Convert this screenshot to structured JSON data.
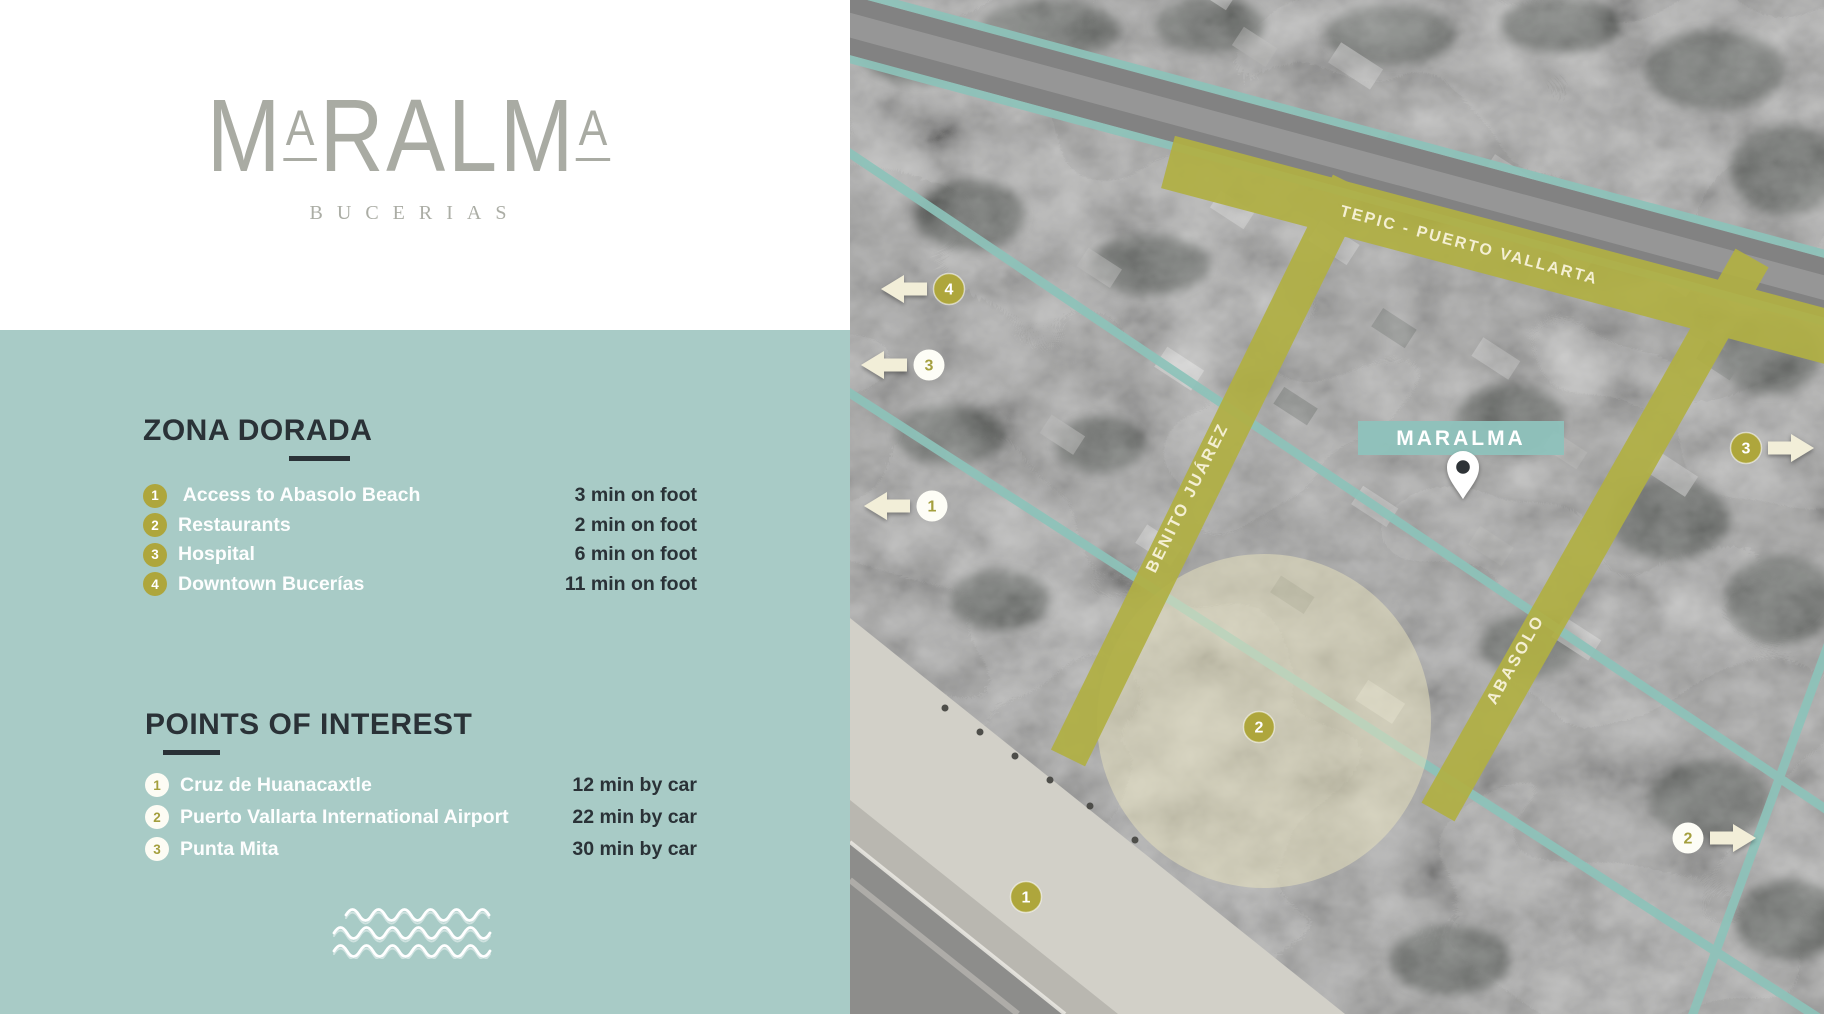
{
  "brand": {
    "logo_word": "MARALMA",
    "logo_letters": [
      {
        "ch": "M",
        "small": false
      },
      {
        "ch": "A",
        "small": true
      },
      {
        "ch": "R",
        "small": false
      },
      {
        "ch": "A",
        "small": false
      },
      {
        "ch": "L",
        "small": false
      },
      {
        "ch": "M",
        "small": false
      },
      {
        "ch": "A",
        "small": true
      }
    ],
    "subtitle": "BUCERIAS"
  },
  "zona_dorada": {
    "title": "ZONA DORADA",
    "items": [
      {
        "num": "1",
        "label": " Access to Abasolo Beach",
        "time": "3 min on foot"
      },
      {
        "num": "2",
        "label": "Restaurants",
        "time": "2 min on foot"
      },
      {
        "num": "3",
        "label": "Hospital",
        "time": "6 min on foot"
      },
      {
        "num": "4",
        "label": "Downtown Bucerías",
        "time": "11 min on foot"
      }
    ]
  },
  "points_of_interest": {
    "title": "POINTS OF INTEREST",
    "items": [
      {
        "num": "1",
        "label": "Cruz de Huanacaxtle",
        "time": "12 min by car"
      },
      {
        "num": "2",
        "label": "Puerto Vallarta International Airport",
        "time": "22 min by car"
      },
      {
        "num": "3",
        "label": "Punta Mita",
        "time": "30 min by car"
      }
    ]
  },
  "map": {
    "property_label": "MARALMA",
    "road_labels": {
      "highway": "TEPIC - PUERTO VALLARTA",
      "benito_juarez": "BENITO JUÁREZ",
      "abasolo": "ABASOLO"
    },
    "markers": {
      "zona_dorada": [
        {
          "num": "1",
          "x": 176,
          "y": 897,
          "arrow": null
        },
        {
          "num": "2",
          "x": 409,
          "y": 727,
          "arrow": null
        },
        {
          "num": "3",
          "x": 896,
          "y": 448,
          "arrow": "right"
        },
        {
          "num": "4",
          "x": 99,
          "y": 289,
          "arrow": "left"
        }
      ],
      "points_of_interest": [
        {
          "num": "1",
          "x": 82,
          "y": 506,
          "arrow": "left"
        },
        {
          "num": "2",
          "x": 838,
          "y": 838,
          "arrow": "right"
        },
        {
          "num": "3",
          "x": 79,
          "y": 365,
          "arrow": "left"
        }
      ]
    }
  },
  "colors": {
    "teal_panel": "#a8cbc6",
    "teal_map": "#8dc3ba",
    "olive_road": "#b1b044",
    "olive_badge": "#aea63c",
    "cream": "#f2eed8",
    "dark_text": "#2a3237",
    "logo_gray": "#a9aba3",
    "badge_number_olive": "#a49f3e",
    "white": "#ffffff"
  }
}
